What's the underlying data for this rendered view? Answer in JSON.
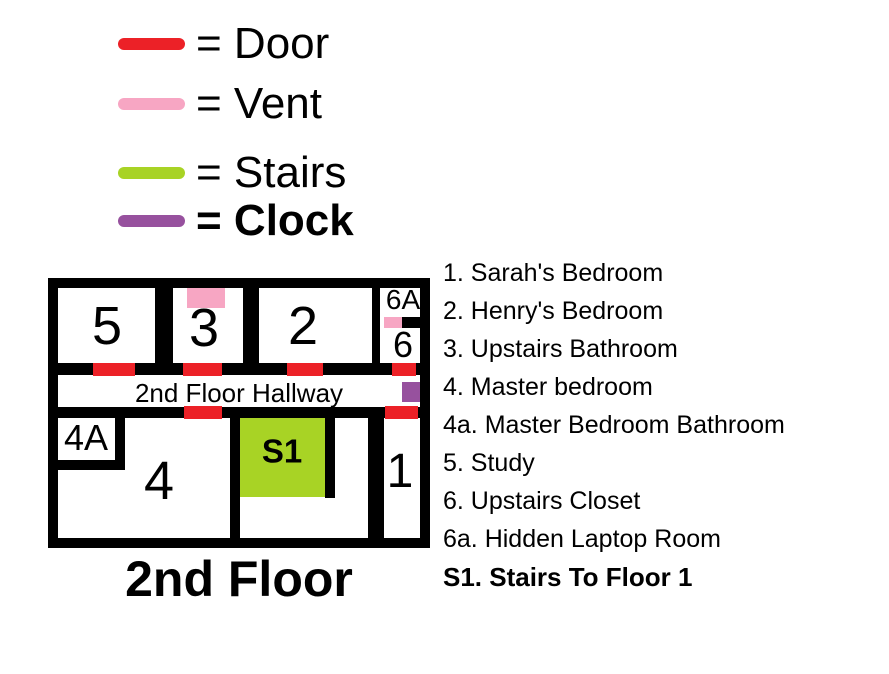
{
  "legend": {
    "items": [
      {
        "id": "door",
        "label": "= Door",
        "color": "#ec2127"
      },
      {
        "id": "vent",
        "label": "= Vent",
        "color": "#f7a6c3"
      },
      {
        "id": "stairs",
        "label": "= Stairs",
        "color": "#a8d325"
      },
      {
        "id": "clock",
        "label": "= Clock",
        "color": "#97519e"
      }
    ]
  },
  "plan": {
    "hallway_label": "2nd Floor Hallway",
    "rooms": {
      "r5": "5",
      "r3": "3",
      "r2": "2",
      "r6a": "6A",
      "r6": "6",
      "r4a": "4A",
      "r4": "4",
      "s1": "S1",
      "r1": "1"
    },
    "colors": {
      "door": "#ec2127",
      "vent": "#f7a6c3",
      "stairs": "#a8d325",
      "clock": "#97519e",
      "wall": "#000000"
    }
  },
  "floor_title": "2nd Floor",
  "room_list": [
    {
      "label": "1. Sarah's Bedroom"
    },
    {
      "label": "2. Henry's Bedroom"
    },
    {
      "label": "3. Upstairs Bathroom"
    },
    {
      "label": "4. Master bedroom"
    },
    {
      "label": "4a. Master Bedroom Bathroom"
    },
    {
      "label": "5. Study"
    },
    {
      "label": "6. Upstairs Closet"
    },
    {
      "label": "6a. Hidden Laptop Room"
    },
    {
      "label": "S1. Stairs To Floor 1"
    }
  ]
}
